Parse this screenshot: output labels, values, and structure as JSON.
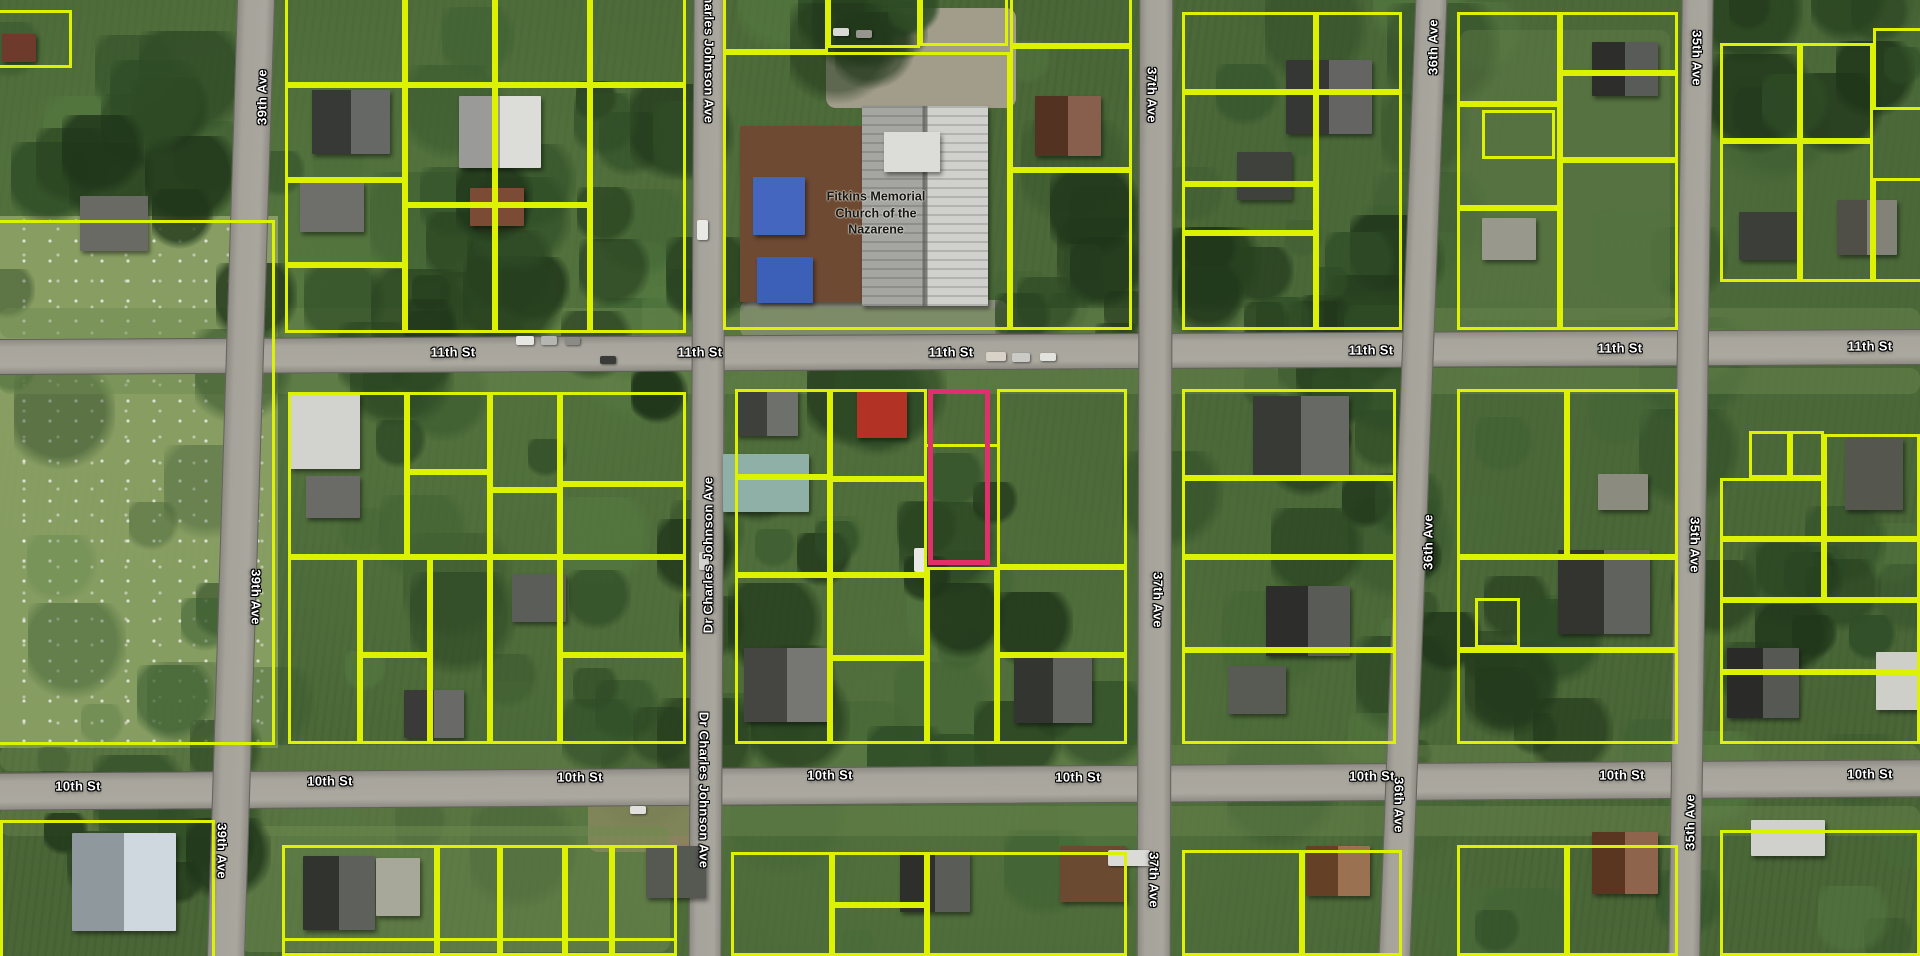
{
  "palette": {
    "parcel_line": "#ddf103",
    "selected_line": "#e0306c",
    "road_fill": "#a8a59d",
    "street_label_text": "#ffffff",
    "street_label_outline": "#000000",
    "place_label_text": "#161616"
  },
  "place_label": {
    "line1": "Fitkins Memorial",
    "line2": "Church of the",
    "line3": "Nazarene",
    "x": 876,
    "y": 213
  },
  "streets_horizontal": [
    {
      "text": "11th St",
      "x": 453,
      "y": 352,
      "rot": -0.3
    },
    {
      "text": "11th St",
      "x": 700,
      "y": 352,
      "rot": -0.3
    },
    {
      "text": "11th St",
      "x": 951,
      "y": 352,
      "rot": -0.3
    },
    {
      "text": "11th St",
      "x": 1371,
      "y": 350,
      "rot": -0.3
    },
    {
      "text": "11th St",
      "x": 1620,
      "y": 348,
      "rot": -0.3
    },
    {
      "text": "11th St",
      "x": 1870,
      "y": 346,
      "rot": -0.3
    },
    {
      "text": "10th St",
      "x": 78,
      "y": 786,
      "rot": -0.4
    },
    {
      "text": "10th St",
      "x": 330,
      "y": 781,
      "rot": -0.4
    },
    {
      "text": "10th St",
      "x": 580,
      "y": 777,
      "rot": -0.4
    },
    {
      "text": "10th St",
      "x": 830,
      "y": 775,
      "rot": -0.4
    },
    {
      "text": "10th St",
      "x": 1078,
      "y": 777,
      "rot": -0.4
    },
    {
      "text": "10th St",
      "x": 1372,
      "y": 776,
      "rot": -0.4
    },
    {
      "text": "10th St",
      "x": 1622,
      "y": 775,
      "rot": -0.4
    },
    {
      "text": "10th St",
      "x": 1870,
      "y": 774,
      "rot": -0.4
    }
  ],
  "streets_vertical": [
    {
      "text": "Dr Charles Johnson Ave",
      "x": 709,
      "y": 45,
      "dir": "down"
    },
    {
      "text": "Dr Charles Johnson Ave",
      "x": 708,
      "y": 555,
      "dir": "up"
    },
    {
      "text": "Dr Charles Johnson Ave",
      "x": 704,
      "y": 790,
      "dir": "down"
    },
    {
      "text": "39th Ave",
      "x": 262,
      "y": 97,
      "dir": "up"
    },
    {
      "text": "39th Ave",
      "x": 256,
      "y": 597,
      "dir": "down"
    },
    {
      "text": "39th Ave",
      "x": 222,
      "y": 851,
      "dir": "down"
    },
    {
      "text": "37th Ave",
      "x": 1152,
      "y": 95,
      "dir": "down"
    },
    {
      "text": "37th Ave",
      "x": 1158,
      "y": 600,
      "dir": "down"
    },
    {
      "text": "37th Ave",
      "x": 1154,
      "y": 880,
      "dir": "down"
    },
    {
      "text": "36th Ave",
      "x": 1433,
      "y": 47,
      "dir": "up"
    },
    {
      "text": "36th Ave",
      "x": 1428,
      "y": 542,
      "dir": "up"
    },
    {
      "text": "36th Ave",
      "x": 1399,
      "y": 805,
      "dir": "down"
    },
    {
      "text": "35th Ave",
      "x": 1697,
      "y": 58,
      "dir": "down"
    },
    {
      "text": "35th Ave",
      "x": 1695,
      "y": 545,
      "dir": "down"
    },
    {
      "text": "35th Ave",
      "x": 1690,
      "y": 822,
      "dir": "up"
    }
  ],
  "roads": {
    "horizontal": [
      {
        "name": "11th St",
        "y": 351,
        "h": 34,
        "rot": -0.3
      },
      {
        "name": "10th St",
        "y": 784,
        "h": 36,
        "rot": -0.4
      }
    ],
    "vertical": [
      {
        "name": "39th Ave",
        "x": 240,
        "w": 36,
        "rot": 1.8
      },
      {
        "name": "Dr Charles Johnson Ave",
        "x": 706,
        "w": 31,
        "rot": 0.3
      },
      {
        "name": "37th Ave",
        "x": 1154,
        "w": 32,
        "rot": 0.15
      },
      {
        "name": "36th Ave",
        "x": 1412,
        "w": 30,
        "rot": 2.2
      },
      {
        "name": "35th Ave",
        "x": 1690,
        "w": 30,
        "rot": 0.8
      }
    ]
  },
  "selected_parcel": {
    "x": 928,
    "y": 389,
    "w": 62,
    "h": 176
  },
  "parcels": {
    "rects": [
      [
        285,
        -40,
        120,
        125
      ],
      [
        285,
        85,
        120,
        95
      ],
      [
        285,
        180,
        120,
        85
      ],
      [
        285,
        265,
        120,
        68
      ],
      [
        405,
        -40,
        90,
        125
      ],
      [
        405,
        85,
        90,
        120
      ],
      [
        405,
        205,
        90,
        128
      ],
      [
        495,
        -40,
        95,
        125
      ],
      [
        495,
        85,
        95,
        120
      ],
      [
        495,
        205,
        95,
        128
      ],
      [
        590,
        -40,
        96,
        125
      ],
      [
        590,
        85,
        96,
        248
      ],
      [
        723,
        -40,
        105,
        92
      ],
      [
        828,
        -40,
        92,
        88
      ],
      [
        920,
        -40,
        88,
        86
      ],
      [
        723,
        52,
        287,
        278
      ],
      [
        1010,
        -40,
        122,
        86
      ],
      [
        1010,
        46,
        122,
        124
      ],
      [
        1010,
        170,
        122,
        160
      ],
      [
        1182,
        12,
        134,
        80
      ],
      [
        1316,
        12,
        86,
        80
      ],
      [
        1182,
        92,
        134,
        92
      ],
      [
        1182,
        184,
        134,
        49
      ],
      [
        1182,
        233,
        134,
        97
      ],
      [
        1316,
        92,
        86,
        238
      ],
      [
        1457,
        12,
        103,
        92
      ],
      [
        1457,
        104,
        103,
        104
      ],
      [
        1457,
        208,
        103,
        122
      ],
      [
        1560,
        12,
        118,
        61
      ],
      [
        1560,
        73,
        118,
        87
      ],
      [
        1560,
        160,
        118,
        170
      ],
      [
        1482,
        110,
        73,
        49
      ],
      [
        1873,
        28,
        60,
        82
      ],
      [
        1720,
        43,
        80,
        98
      ],
      [
        1800,
        43,
        73,
        98
      ],
      [
        1720,
        141,
        80,
        141
      ],
      [
        1800,
        141,
        73,
        141
      ],
      [
        1873,
        178,
        60,
        104
      ],
      [
        -60,
        220,
        335,
        525
      ],
      [
        -20,
        10,
        92,
        58
      ],
      [
        288,
        392,
        119,
        165
      ],
      [
        288,
        557,
        72,
        187
      ],
      [
        360,
        557,
        70,
        98
      ],
      [
        360,
        655,
        70,
        89
      ],
      [
        430,
        557,
        60,
        187
      ],
      [
        407,
        392,
        83,
        80
      ],
      [
        407,
        472,
        83,
        85
      ],
      [
        490,
        392,
        70,
        98
      ],
      [
        490,
        490,
        70,
        67
      ],
      [
        490,
        557,
        70,
        187
      ],
      [
        560,
        392,
        126,
        92
      ],
      [
        560,
        484,
        126,
        73
      ],
      [
        560,
        557,
        126,
        98
      ],
      [
        560,
        655,
        126,
        89
      ],
      [
        735,
        389,
        95,
        88
      ],
      [
        735,
        477,
        95,
        98
      ],
      [
        830,
        389,
        97,
        90
      ],
      [
        830,
        479,
        97,
        96
      ],
      [
        997,
        389,
        130,
        178
      ],
      [
        735,
        575,
        95,
        169
      ],
      [
        830,
        575,
        97,
        83
      ],
      [
        830,
        658,
        97,
        86
      ],
      [
        927,
        567,
        70,
        177
      ],
      [
        997,
        567,
        130,
        88
      ],
      [
        997,
        655,
        130,
        89
      ],
      [
        1182,
        389,
        214,
        89
      ],
      [
        1182,
        478,
        214,
        79
      ],
      [
        1182,
        557,
        214,
        93
      ],
      [
        1182,
        650,
        214,
        94
      ],
      [
        1457,
        389,
        110,
        168
      ],
      [
        1567,
        389,
        111,
        168
      ],
      [
        1457,
        557,
        221,
        93
      ],
      [
        1457,
        650,
        221,
        94
      ],
      [
        1475,
        598,
        45,
        50
      ],
      [
        1749,
        431,
        41,
        47
      ],
      [
        1790,
        431,
        34,
        47
      ],
      [
        1720,
        478,
        104,
        61
      ],
      [
        1824,
        434,
        96,
        105
      ],
      [
        1720,
        539,
        104,
        61
      ],
      [
        1824,
        539,
        96,
        61
      ],
      [
        1720,
        600,
        200,
        72
      ],
      [
        1720,
        672,
        200,
        72
      ],
      [
        0,
        820,
        215,
        140
      ],
      [
        282,
        845,
        155,
        111
      ],
      [
        437,
        845,
        63,
        111
      ],
      [
        500,
        845,
        65,
        111
      ],
      [
        565,
        845,
        47,
        111
      ],
      [
        612,
        845,
        65,
        111
      ],
      [
        731,
        852,
        101,
        104
      ],
      [
        832,
        852,
        95,
        53
      ],
      [
        832,
        905,
        95,
        51
      ],
      [
        927,
        852,
        200,
        104
      ],
      [
        1182,
        850,
        120,
        106
      ],
      [
        1302,
        850,
        100,
        106
      ],
      [
        1457,
        845,
        110,
        111
      ],
      [
        1567,
        845,
        111,
        111
      ],
      [
        1720,
        830,
        200,
        126
      ]
    ],
    "segments": [
      [
        282,
        938,
        395,
        3
      ],
      [
        927,
        444,
        70,
        3
      ]
    ]
  },
  "buildings": [
    {
      "x": 312,
      "y": 90,
      "w": 78,
      "h": 64,
      "c": "#4c4f4a",
      "gable": true
    },
    {
      "x": 459,
      "y": 96,
      "w": 82,
      "h": 72,
      "c": "#d6d6d2",
      "gable": true
    },
    {
      "x": 300,
      "y": 182,
      "w": 64,
      "h": 50,
      "c": "#6e6f6a"
    },
    {
      "x": 470,
      "y": 188,
      "w": 54,
      "h": 38,
      "c": "#7b4b36"
    },
    {
      "x": 80,
      "y": 196,
      "w": 68,
      "h": 55,
      "c": "#6a6a64"
    },
    {
      "x": 2,
      "y": 34,
      "w": 34,
      "h": 28,
      "c": "#6e3a2c"
    },
    {
      "x": 740,
      "y": 126,
      "w": 128,
      "h": 176,
      "c": "#6e4a33"
    },
    {
      "x": 862,
      "y": 106,
      "w": 126,
      "h": 200,
      "c": "#c9c9c5",
      "ribbed": true
    },
    {
      "x": 753,
      "y": 177,
      "w": 52,
      "h": 58,
      "c": "#4466be"
    },
    {
      "x": 757,
      "y": 257,
      "w": 56,
      "h": 46,
      "c": "#3c5fb8"
    },
    {
      "x": 884,
      "y": 132,
      "w": 56,
      "h": 40,
      "c": "#dcdcd8"
    },
    {
      "x": 1035,
      "y": 96,
      "w": 66,
      "h": 60,
      "c": "#74452e",
      "gable": true
    },
    {
      "x": 1286,
      "y": 60,
      "w": 86,
      "h": 74,
      "c": "#4a4c48",
      "gable": true
    },
    {
      "x": 1237,
      "y": 152,
      "w": 55,
      "h": 48,
      "c": "#3f413d"
    },
    {
      "x": 1592,
      "y": 42,
      "w": 66,
      "h": 54,
      "c": "#3e403c",
      "gable": true
    },
    {
      "x": 1482,
      "y": 218,
      "w": 54,
      "h": 42,
      "c": "#99988c"
    },
    {
      "x": 1739,
      "y": 212,
      "w": 60,
      "h": 48,
      "c": "#3c3e3a"
    },
    {
      "x": 1837,
      "y": 200,
      "w": 60,
      "h": 55,
      "c": "#6d6d62",
      "gable": true
    },
    {
      "x": 290,
      "y": 393,
      "w": 70,
      "h": 76,
      "c": "#d2d2ce"
    },
    {
      "x": 306,
      "y": 476,
      "w": 54,
      "h": 42,
      "c": "#6a6b66"
    },
    {
      "x": 404,
      "y": 690,
      "w": 60,
      "h": 48,
      "c": "#50524e",
      "gable": true
    },
    {
      "x": 512,
      "y": 574,
      "w": 54,
      "h": 48,
      "c": "#5b5d58"
    },
    {
      "x": 736,
      "y": 389,
      "w": 62,
      "h": 47,
      "c": "#565853",
      "gable": true
    },
    {
      "x": 723,
      "y": 454,
      "w": 86,
      "h": 58,
      "c": "#8fb0a6"
    },
    {
      "x": 857,
      "y": 391,
      "w": 50,
      "h": 47,
      "c": "#b23226"
    },
    {
      "x": 744,
      "y": 648,
      "w": 86,
      "h": 74,
      "c": "#5f615c",
      "gable": true
    },
    {
      "x": 1014,
      "y": 653,
      "w": 78,
      "h": 70,
      "c": "#474944",
      "gable": true
    },
    {
      "x": 1253,
      "y": 396,
      "w": 96,
      "h": 80,
      "c": "#4e504b",
      "gable": true
    },
    {
      "x": 1266,
      "y": 586,
      "w": 84,
      "h": 70,
      "c": "#3e403b",
      "gable": true
    },
    {
      "x": 1228,
      "y": 666,
      "w": 58,
      "h": 48,
      "c": "#585a54"
    },
    {
      "x": 1558,
      "y": 550,
      "w": 92,
      "h": 84,
      "c": "#464843",
      "gable": true
    },
    {
      "x": 1598,
      "y": 474,
      "w": 50,
      "h": 36,
      "c": "#8b8b80"
    },
    {
      "x": 1845,
      "y": 438,
      "w": 58,
      "h": 72,
      "c": "#55574f"
    },
    {
      "x": 1727,
      "y": 648,
      "w": 72,
      "h": 70,
      "c": "#3a3c37",
      "gable": true
    },
    {
      "x": 1876,
      "y": 652,
      "w": 44,
      "h": 58,
      "c": "#cfcfca"
    },
    {
      "x": 72,
      "y": 833,
      "w": 104,
      "h": 98,
      "c": "#c6d2d8",
      "gable": true
    },
    {
      "x": 303,
      "y": 856,
      "w": 72,
      "h": 74,
      "c": "#444641",
      "gable": true
    },
    {
      "x": 376,
      "y": 858,
      "w": 44,
      "h": 58,
      "c": "#a8a89a"
    },
    {
      "x": 646,
      "y": 846,
      "w": 60,
      "h": 52,
      "c": "#565852"
    },
    {
      "x": 900,
      "y": 852,
      "w": 70,
      "h": 60,
      "c": "#3f413c",
      "gable": true
    },
    {
      "x": 1060,
      "y": 846,
      "w": 66,
      "h": 56,
      "c": "#6b4a32"
    },
    {
      "x": 1306,
      "y": 846,
      "w": 64,
      "h": 50,
      "c": "#8a5a34",
      "gable": true
    },
    {
      "x": 1592,
      "y": 832,
      "w": 66,
      "h": 62,
      "c": "#7c4a2e",
      "gable": true
    },
    {
      "x": 1751,
      "y": 820,
      "w": 74,
      "h": 36,
      "c": "#d0d0cc"
    }
  ],
  "vehicles": [
    {
      "x": 516,
      "y": 336,
      "w": 18,
      "h": 9,
      "c": "#e6e6e2"
    },
    {
      "x": 541,
      "y": 336,
      "w": 16,
      "h": 9,
      "c": "#b5b5b1"
    },
    {
      "x": 565,
      "y": 337,
      "w": 15,
      "h": 8,
      "c": "#8a8a86"
    },
    {
      "x": 600,
      "y": 356,
      "w": 16,
      "h": 8,
      "c": "#3a3a38"
    },
    {
      "x": 986,
      "y": 352,
      "w": 20,
      "h": 9,
      "c": "#d8d2c8"
    },
    {
      "x": 1012,
      "y": 353,
      "w": 18,
      "h": 9,
      "c": "#cacac6"
    },
    {
      "x": 1040,
      "y": 353,
      "w": 16,
      "h": 8,
      "c": "#e2e2de"
    },
    {
      "x": 697,
      "y": 220,
      "w": 11,
      "h": 20,
      "c": "#e8e8e4"
    },
    {
      "x": 699,
      "y": 552,
      "w": 10,
      "h": 18,
      "c": "#d2d2ce"
    },
    {
      "x": 914,
      "y": 548,
      "w": 12,
      "h": 24,
      "c": "#e8e8e4"
    },
    {
      "x": 833,
      "y": 28,
      "w": 16,
      "h": 8,
      "c": "#d8d8d4"
    },
    {
      "x": 856,
      "y": 30,
      "w": 16,
      "h": 8,
      "c": "#96968f"
    },
    {
      "x": 1108,
      "y": 850,
      "w": 42,
      "h": 16,
      "c": "#dadad6"
    },
    {
      "x": 630,
      "y": 806,
      "w": 16,
      "h": 8,
      "c": "#e0e0dc"
    }
  ]
}
